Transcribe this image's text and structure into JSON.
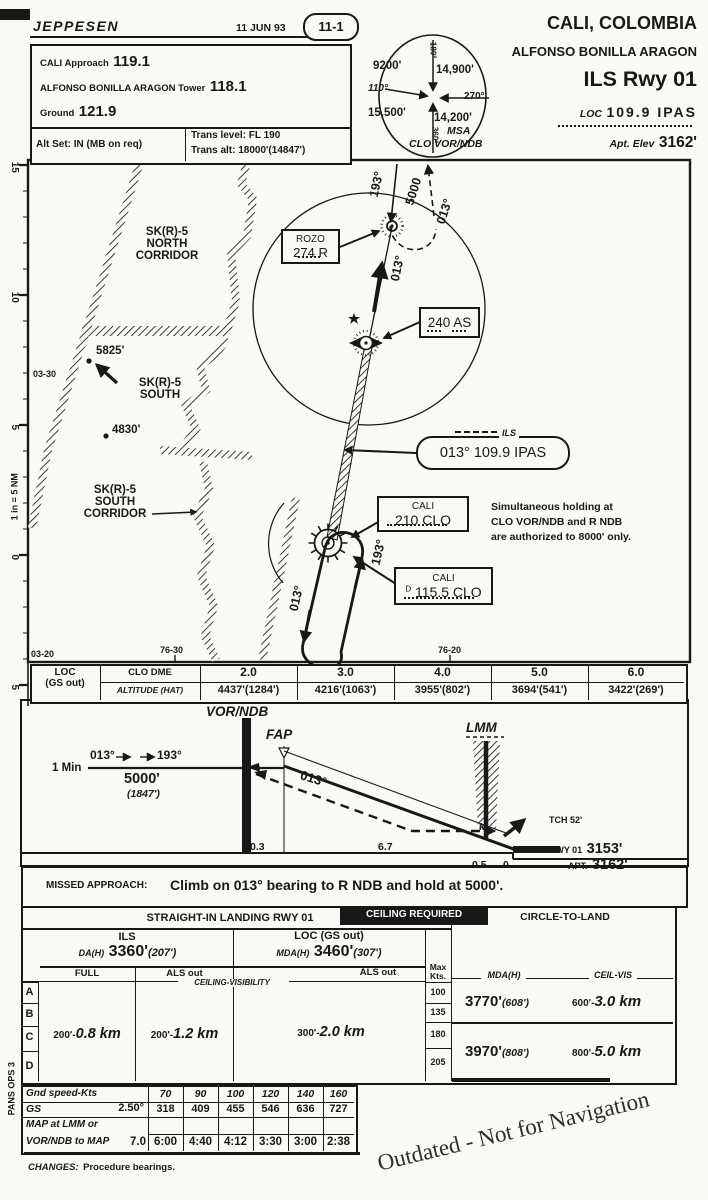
{
  "header": {
    "logo": "JEPPESEN",
    "date": "11 JUN 93",
    "index": "11-1",
    "comm": [
      {
        "label": "CALI Approach",
        "freq": "119.1"
      },
      {
        "label": "ALFONSO BONILLA ARAGON Tower",
        "freq": "118.1"
      },
      {
        "label": "Ground",
        "freq": "121.9"
      }
    ],
    "alt_set": "Alt Set: IN (MB on req)",
    "trans_level": "Trans level: FL 190",
    "trans_alt": "Trans alt: 18000'(14847')",
    "city": "CALI, COLOMBIA",
    "airport": "ALFONSO BONILLA ARAGON",
    "procedure": "ILS Rwy 01",
    "loc_label": "LOC",
    "loc_value": "109.9 IPAS",
    "apt_elev_label": "Apt. Elev",
    "apt_elev": "3162'"
  },
  "msa": {
    "title": "MSA",
    "facility": "CLO VOR/NDB",
    "nw": "9200'",
    "ne": "14,900'",
    "sw": "15,500'",
    "se": "14,200'",
    "brg_top": "180°",
    "brg_left": "110°",
    "brg_right": "270°",
    "brg_bottom": "360°"
  },
  "plan": {
    "ruler": [
      "15",
      "10",
      "5",
      "0",
      "5"
    ],
    "scale": "1 in = 5 NM",
    "lat": [
      "03-30",
      "03-20"
    ],
    "lon": [
      "76-30",
      "76-20"
    ],
    "area1": [
      "SK(R)-5",
      "NORTH",
      "CORRIDOR"
    ],
    "area2": [
      "SK(R)-5",
      "SOUTH"
    ],
    "area3": [
      "SK(R)-5",
      "SOUTH",
      "CORRIDOR"
    ],
    "obstacle1": "5825'",
    "obstacle2": "4830'",
    "rozo_name": "ROZO",
    "rozo_ident": "274 R",
    "rozo_hold_inbound": "193°",
    "rozo_hold_alt": "5000",
    "rozo_hold_outbound": "013°",
    "course": "013°",
    "as_ident": "240 AS",
    "ils_tag": "ILS",
    "ils_value": "013° 109.9 IPAS",
    "ndb_name": "CALI",
    "ndb_ident": "210 CLO",
    "vor_name": "CALI",
    "vor_dme": "D",
    "vor_ident": "115.5 CLO",
    "clo_hold_outbound": "013°",
    "clo_hold_inbound": "193°",
    "note": [
      "Simultaneous holding at",
      "CLO VOR/NDB and R NDB",
      "are authorized to 8000' only."
    ]
  },
  "loc_table": {
    "title": "LOC",
    "subtitle": "(GS out)",
    "dme_label": "CLO DME",
    "alt_label": "ALTITUDE (HAT)",
    "dme": [
      "2.0",
      "3.0",
      "4.0",
      "5.0",
      "6.0"
    ],
    "altitudes": [
      "4437'(1284')",
      "4216'(1063')",
      "3955'(802')",
      "3694'(541')",
      "3422'(269')"
    ]
  },
  "profile": {
    "vor": "VOR/NDB",
    "fap": "FAP",
    "lmm": "LMM",
    "marker": "M",
    "one_min": "1 Min",
    "crs_out": "013°",
    "crs_in": "193°",
    "hold_alt": "5000'",
    "hold_hat": "(1847')",
    "gs_crs": "013°",
    "d1": "0.3",
    "d2": "6.7",
    "d3": "0.5",
    "d4": "0",
    "tch": "TCH 52'",
    "rwy_label": "RWY 01",
    "rwy_elev": "3153'",
    "apt_label": "APT.",
    "apt_elev": "3162'"
  },
  "missed": {
    "label": "MISSED APPROACH:",
    "text": "Climb on 013° bearing to R NDB and hold at 5000'."
  },
  "minimums": {
    "straight_in": "STRAIGHT-IN LANDING RWY 01",
    "ceiling": "CEILING REQUIRED",
    "circle": "CIRCLE-TO-LAND",
    "ils": "ILS",
    "da_label": "DA(H)",
    "da": "3360'",
    "da_hat": "(207')",
    "loc": "LOC (GS out)",
    "mda_label": "MDA(H)",
    "mda": "3460'",
    "mda_hat": "(307')",
    "full": "FULL",
    "als_out_1": "ALS out",
    "als_out_2": "ALS out",
    "ceiling_visibility": "CEILING-VISIBILITY",
    "max": "Max",
    "kts": "Kts.",
    "cats": [
      "A",
      "B",
      "C",
      "D"
    ],
    "max_kts": [
      "100",
      "135",
      "180",
      "205"
    ],
    "v_full_pre": "200'-",
    "v_full": "0.8 km",
    "v_als_pre": "200'-",
    "v_als": "1.2 km",
    "v_loc_pre": "300'-",
    "v_loc": "2.0 km",
    "c_mda_label": "MDA(H)",
    "c_vis_label": "CEIL-VIS",
    "c1_mda": "3770'",
    "c1_hat": "(608')",
    "c1_pre": "600'-",
    "c1_vis": "3.0 km",
    "c2_mda": "3970'",
    "c2_hat": "(808')",
    "c2_pre": "800'-",
    "c2_vis": "5.0 km"
  },
  "speed_table": {
    "r1": "Gnd speed-Kts",
    "speeds": [
      "70",
      "90",
      "100",
      "120",
      "140",
      "160"
    ],
    "r2": "GS",
    "angle": "2.50°",
    "gs": [
      "318",
      "409",
      "455",
      "546",
      "636",
      "727"
    ],
    "r3a": "MAP at LMM or",
    "r3b": "VOR/NDB to MAP",
    "dist": "7.0",
    "times": [
      "6:00",
      "4:40",
      "4:12",
      "3:30",
      "3:00",
      "2:38"
    ]
  },
  "footer": {
    "changes_label": "CHANGES:",
    "changes": "Procedure bearings.",
    "watermark": "Outdated - Not for Navigation",
    "side": "PANS OPS 3"
  }
}
